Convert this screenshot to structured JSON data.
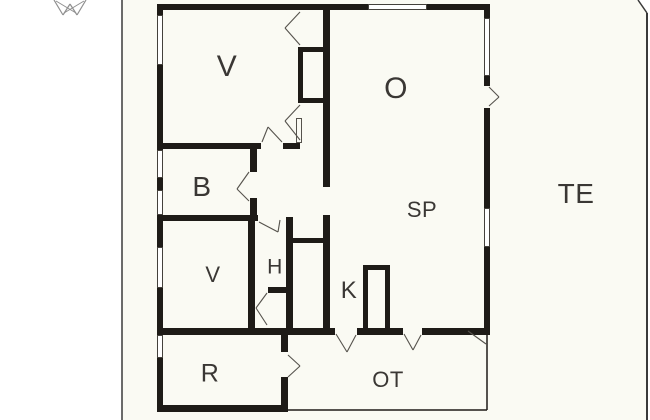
{
  "meta": {
    "title": "Floor plan drawing",
    "sheet_type": "architectural-floor-plan"
  },
  "colors": {
    "sheet_bg": "#fafaf3",
    "page_bg": "#ffffff",
    "wall": "#1e1b17",
    "label": "#3a3734",
    "edge": "#3a3a3a",
    "door": "#55524c",
    "compass": "#8f8f8f",
    "window_fill": "#ffffff"
  },
  "rooms": [
    {
      "id": "v1",
      "label": "V",
      "x": 227,
      "y": 67,
      "size": 30
    },
    {
      "id": "o",
      "label": "O",
      "x": 396,
      "y": 89,
      "size": 30
    },
    {
      "id": "b",
      "label": "B",
      "x": 202,
      "y": 187,
      "size": 28
    },
    {
      "id": "te",
      "label": "TE",
      "x": 576,
      "y": 194,
      "size": 28
    },
    {
      "id": "sp",
      "label": "SP",
      "x": 422,
      "y": 210,
      "size": 22
    },
    {
      "id": "v2",
      "label": "V",
      "x": 213,
      "y": 275,
      "size": 22
    },
    {
      "id": "h",
      "label": "H",
      "x": 275,
      "y": 267,
      "size": 21
    },
    {
      "id": "k",
      "label": "K",
      "x": 349,
      "y": 291,
      "size": 24
    },
    {
      "id": "r",
      "label": "R",
      "x": 210,
      "y": 374,
      "size": 25
    },
    {
      "id": "ot",
      "label": "OT",
      "x": 388,
      "y": 380,
      "size": 22
    }
  ],
  "plan": {
    "walls": [
      [
        157,
        4,
        333,
        6
      ],
      [
        157,
        4,
        6,
        408
      ],
      [
        484,
        4,
        6,
        329
      ],
      [
        157,
        328,
        333,
        7
      ],
      [
        157,
        405,
        131,
        7
      ],
      [
        281,
        333,
        7,
        79
      ],
      [
        323,
        4,
        7,
        183
      ],
      [
        298,
        47,
        5,
        56
      ],
      [
        298,
        47,
        25,
        5
      ],
      [
        298,
        98,
        25,
        5
      ],
      [
        157,
        143,
        104,
        6
      ],
      [
        283,
        143,
        17,
        6
      ],
      [
        250,
        148,
        7,
        24
      ],
      [
        250,
        198,
        7,
        20
      ],
      [
        157,
        215,
        101,
        6
      ],
      [
        248,
        220,
        7,
        110
      ],
      [
        286,
        217,
        7,
        113
      ],
      [
        268,
        287,
        25,
        6
      ],
      [
        293,
        238,
        30,
        5
      ],
      [
        323,
        215,
        7,
        115
      ],
      [
        363,
        265,
        5,
        67
      ],
      [
        385,
        265,
        5,
        67
      ],
      [
        363,
        265,
        27,
        5
      ]
    ],
    "windows": [
      [
        157,
        15,
        6,
        50
      ],
      [
        157,
        150,
        6,
        28
      ],
      [
        157,
        190,
        6,
        25
      ],
      [
        157,
        247,
        6,
        41
      ],
      [
        157,
        335,
        6,
        23
      ],
      [
        484,
        18,
        6,
        58
      ],
      [
        484,
        208,
        6,
        39
      ],
      [
        368,
        4,
        59,
        6
      ]
    ],
    "openings": [
      [
        484,
        86,
        6,
        22
      ],
      [
        335,
        328,
        22,
        7
      ],
      [
        403,
        328,
        19,
        7
      ],
      [
        281,
        352,
        7,
        25
      ]
    ],
    "thin_rects": [
      [
        296,
        118,
        6,
        25
      ]
    ],
    "lines": [
      {
        "n": "sheet-left-edge",
        "c": "edge",
        "w": 1.5,
        "x1": 122,
        "y1": 0,
        "x2": 122,
        "y2": 420
      },
      {
        "n": "sheet-corner-cut",
        "c": "edge",
        "w": 1.5,
        "x1": 638,
        "y1": 0,
        "x2": 647,
        "y2": 13
      },
      {
        "n": "sheet-right-edge",
        "c": "edge",
        "w": 2,
        "x1": 647,
        "y1": 13,
        "x2": 647,
        "y2": 420
      },
      {
        "n": "ot-right-boundary",
        "c": "wall",
        "w": 1.5,
        "x1": 487,
        "y1": 333,
        "x2": 487,
        "y2": 410
      },
      {
        "n": "ot-bottom-boundary",
        "c": "wall",
        "w": 1.5,
        "x1": 288,
        "y1": 410,
        "x2": 487,
        "y2": 410
      },
      {
        "n": "north-arrow-line",
        "c": "compass",
        "w": 1.2,
        "x1": 54,
        "y1": 0,
        "x2": 63,
        "y2": 15
      },
      {
        "n": "north-arrow-line",
        "c": "compass",
        "w": 1.2,
        "x1": 63,
        "y1": 15,
        "x2": 70,
        "y2": 4
      },
      {
        "n": "north-arrow-line",
        "c": "compass",
        "w": 1.2,
        "x1": 70,
        "y1": 4,
        "x2": 77,
        "y2": 15
      },
      {
        "n": "north-arrow-line",
        "c": "compass",
        "w": 1.2,
        "x1": 77,
        "y1": 15,
        "x2": 86,
        "y2": 0
      },
      {
        "n": "north-arrow-line",
        "c": "compass",
        "w": 1,
        "x1": 56,
        "y1": 1,
        "x2": 76,
        "y2": 13
      },
      {
        "n": "north-arrow-line",
        "c": "compass",
        "w": 1,
        "x1": 84,
        "y1": 1,
        "x2": 64,
        "y2": 13
      },
      {
        "n": "door-swing-line",
        "c": "door",
        "w": 1.1,
        "x1": 300,
        "y1": 12,
        "x2": 285,
        "y2": 28
      },
      {
        "n": "door-swing-line",
        "c": "door",
        "w": 1.1,
        "x1": 285,
        "y1": 28,
        "x2": 300,
        "y2": 45
      },
      {
        "n": "door-swing-line",
        "c": "door",
        "w": 1.1,
        "x1": 300,
        "y1": 105,
        "x2": 285,
        "y2": 121
      },
      {
        "n": "door-swing-line",
        "c": "door",
        "w": 1.1,
        "x1": 285,
        "y1": 121,
        "x2": 300,
        "y2": 140
      },
      {
        "n": "door-swing-line",
        "c": "door",
        "w": 1.1,
        "x1": 282,
        "y1": 142,
        "x2": 268,
        "y2": 127
      },
      {
        "n": "door-swing-line",
        "c": "door",
        "w": 1.1,
        "x1": 268,
        "y1": 127,
        "x2": 262,
        "y2": 142
      },
      {
        "n": "door-swing-line",
        "c": "door",
        "w": 1.1,
        "x1": 249,
        "y1": 172,
        "x2": 237,
        "y2": 189
      },
      {
        "n": "door-swing-line",
        "c": "door",
        "w": 1.1,
        "x1": 237,
        "y1": 189,
        "x2": 249,
        "y2": 201
      },
      {
        "n": "door-swing-line",
        "c": "door",
        "w": 1.1,
        "x1": 259,
        "y1": 222,
        "x2": 278,
        "y2": 232
      },
      {
        "n": "door-swing-line",
        "c": "door",
        "w": 1.1,
        "x1": 278,
        "y1": 232,
        "x2": 280,
        "y2": 220
      },
      {
        "n": "door-swing-line",
        "c": "door",
        "w": 1.1,
        "x1": 267,
        "y1": 293,
        "x2": 256,
        "y2": 308
      },
      {
        "n": "door-swing-line",
        "c": "door",
        "w": 1.1,
        "x1": 256,
        "y1": 308,
        "x2": 267,
        "y2": 325
      },
      {
        "n": "door-swing-line",
        "c": "door",
        "w": 1.1,
        "x1": 489,
        "y1": 87,
        "x2": 499,
        "y2": 97
      },
      {
        "n": "door-swing-line",
        "c": "door",
        "w": 1.1,
        "x1": 499,
        "y1": 97,
        "x2": 489,
        "y2": 106
      },
      {
        "n": "door-swing-line",
        "c": "door",
        "w": 1.1,
        "x1": 336,
        "y1": 334,
        "x2": 347,
        "y2": 352
      },
      {
        "n": "door-swing-line",
        "c": "door",
        "w": 1.1,
        "x1": 347,
        "y1": 352,
        "x2": 356,
        "y2": 335
      },
      {
        "n": "door-swing-line",
        "c": "door",
        "w": 1.1,
        "x1": 404,
        "y1": 334,
        "x2": 413,
        "y2": 350
      },
      {
        "n": "door-swing-line",
        "c": "door",
        "w": 1.1,
        "x1": 413,
        "y1": 350,
        "x2": 421,
        "y2": 335
      },
      {
        "n": "door-swing-line",
        "c": "door",
        "w": 1.1,
        "x1": 288,
        "y1": 355,
        "x2": 300,
        "y2": 366
      },
      {
        "n": "door-swing-line",
        "c": "door",
        "w": 1.1,
        "x1": 300,
        "y1": 366,
        "x2": 288,
        "y2": 377
      },
      {
        "n": "door-swing-line",
        "c": "door",
        "w": 1.1,
        "x1": 468,
        "y1": 331,
        "x2": 486,
        "y2": 344
      }
    ]
  }
}
